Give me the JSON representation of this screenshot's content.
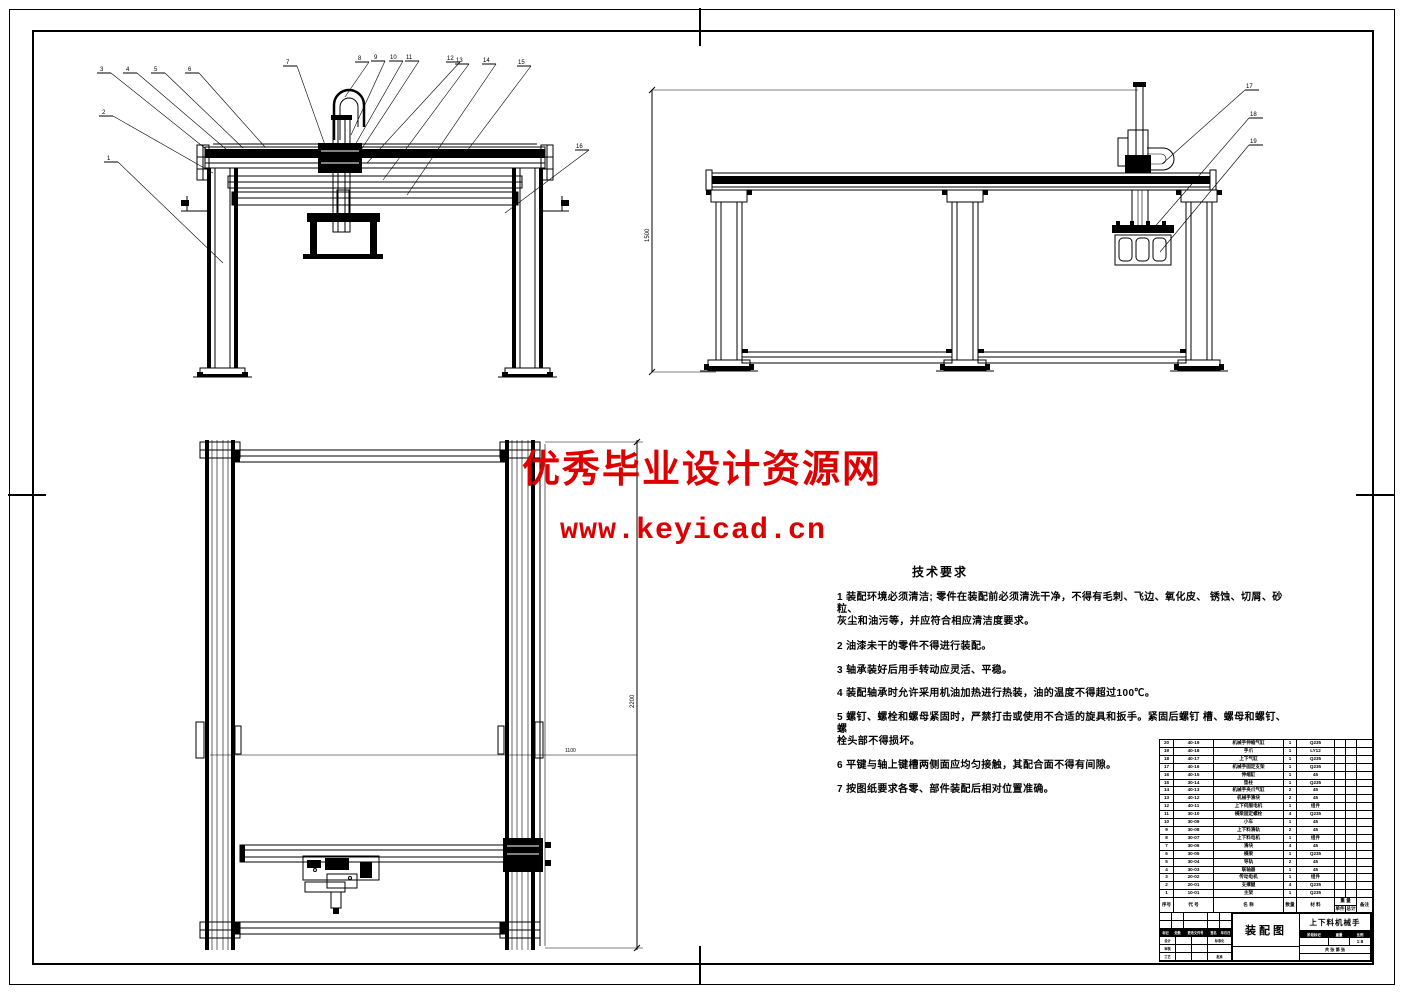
{
  "sheet": {
    "background": "#ffffff",
    "line_color": "#000000",
    "watermark_color": "#dd0000"
  },
  "watermarks": {
    "line1": "优秀毕业设计资源网",
    "line2": "www.keyicad.cn"
  },
  "tech": {
    "title": "技术要求",
    "lines": [
      "1 装配环境必须清洁; 零件在装配前必须清洗干净，不得有毛刺、飞边、氧化皮、  锈蚀、切屑、砂粒、",
      "灰尘和油污等，并应符合相应清洁度要求。",
      "2 油漆未干的零件不得进行装配。",
      "3 轴承装好后用手转动应灵活、平稳。",
      "4 装配轴承时允许采用机油加热进行热装，油的温度不得超过100℃。",
      "5 螺钉、螺栓和螺母紧固时，严禁打击或使用不合适的旋具和扳手。紧固后螺钉   槽、螺母和螺钉、螺",
      "栓头部不得损坏。",
      "6 平键与轴上键槽两侧面应均匀接触，其配合面不得有间隙。",
      "7 按图纸要求各零、部件装配后相对位置准确。"
    ]
  },
  "views": {
    "front": {
      "callouts": [
        "1",
        "2",
        "3",
        "4",
        "5",
        "6",
        "7",
        "8",
        "9",
        "10",
        "11",
        "12",
        "13",
        "14",
        "15",
        "16"
      ]
    },
    "side": {
      "callouts": [
        "17",
        "18",
        "19"
      ],
      "dim_height": "1500"
    },
    "plan": {
      "dim_length": "2200",
      "dim_mid": "1100"
    }
  },
  "bom": {
    "headers": {
      "seq": "序号",
      "code": "代 号",
      "name": "名 称",
      "qty": "数量",
      "material": "材 料",
      "weight": "重 量",
      "unit": "单件",
      "total": "总计",
      "remark": "备注"
    },
    "rows": [
      {
        "seq": "20",
        "code": "40-19",
        "name": "机械手伸缩气缸",
        "qty": "1",
        "material": "Q235",
        "unit_weight": "",
        "total_weight": "",
        "remark": ""
      },
      {
        "seq": "19",
        "code": "40-18",
        "name": "手爪",
        "qty": "1",
        "material": "LY12",
        "unit_weight": "",
        "total_weight": "",
        "remark": ""
      },
      {
        "seq": "18",
        "code": "40-17",
        "name": "上下气缸",
        "qty": "1",
        "material": "Q235",
        "unit_weight": "",
        "total_weight": "",
        "remark": ""
      },
      {
        "seq": "17",
        "code": "40-16",
        "name": "机械手固定支架",
        "qty": "1",
        "material": "Q235",
        "unit_weight": "",
        "total_weight": "",
        "remark": ""
      },
      {
        "seq": "16",
        "code": "40-15",
        "name": "伸缩缸",
        "qty": "1",
        "material": "45",
        "unit_weight": "",
        "total_weight": "",
        "remark": ""
      },
      {
        "seq": "15",
        "code": "30-14",
        "name": "垫柱",
        "qty": "1",
        "material": "Q235",
        "unit_weight": "",
        "total_weight": "",
        "remark": ""
      },
      {
        "seq": "14",
        "code": "40-13",
        "name": "机械手夹爪气缸",
        "qty": "2",
        "material": "45",
        "unit_weight": "",
        "total_weight": "",
        "remark": ""
      },
      {
        "seq": "13",
        "code": "40-12",
        "name": "机械手滑块",
        "qty": "2",
        "material": "45",
        "unit_weight": "",
        "total_weight": "",
        "remark": ""
      },
      {
        "seq": "12",
        "code": "40-11",
        "name": "上下伺服电机",
        "qty": "1",
        "material": "组件",
        "unit_weight": "",
        "total_weight": "",
        "remark": ""
      },
      {
        "seq": "11",
        "code": "30-10",
        "name": "横梁固定螺栓",
        "qty": "4",
        "material": "Q235",
        "unit_weight": "",
        "total_weight": "",
        "remark": ""
      },
      {
        "seq": "10",
        "code": "30-09",
        "name": "小车",
        "qty": "1",
        "material": "45",
        "unit_weight": "",
        "total_weight": "",
        "remark": ""
      },
      {
        "seq": "9",
        "code": "30-08",
        "name": "上下料滑轨",
        "qty": "2",
        "material": "45",
        "unit_weight": "",
        "total_weight": "",
        "remark": ""
      },
      {
        "seq": "8",
        "code": "30-07",
        "name": "上下料电机",
        "qty": "1",
        "material": "组件",
        "unit_weight": "",
        "total_weight": "",
        "remark": ""
      },
      {
        "seq": "7",
        "code": "30-06",
        "name": "滑块",
        "qty": "4",
        "material": "45",
        "unit_weight": "",
        "total_weight": "",
        "remark": ""
      },
      {
        "seq": "6",
        "code": "30-05",
        "name": "横梁",
        "qty": "1",
        "material": "Q235",
        "unit_weight": "",
        "total_weight": "",
        "remark": ""
      },
      {
        "seq": "5",
        "code": "30-04",
        "name": "导轨",
        "qty": "2",
        "material": "45",
        "unit_weight": "",
        "total_weight": "",
        "remark": ""
      },
      {
        "seq": "4",
        "code": "30-03",
        "name": "联轴器",
        "qty": "1",
        "material": "45",
        "unit_weight": "",
        "total_weight": "",
        "remark": ""
      },
      {
        "seq": "3",
        "code": "20-02",
        "name": "传动电机",
        "qty": "1",
        "material": "组件",
        "unit_weight": "",
        "total_weight": "",
        "remark": ""
      },
      {
        "seq": "2",
        "code": "20-01",
        "name": "支撑腿",
        "qty": "4",
        "material": "Q235",
        "unit_weight": "",
        "total_weight": "",
        "remark": ""
      },
      {
        "seq": "1",
        "code": "10-01",
        "name": "主架",
        "qty": "1",
        "material": "Q235",
        "unit_weight": "",
        "total_weight": "",
        "remark": ""
      }
    ]
  },
  "title_block": {
    "drawing_name": "装配图",
    "project_name": "上下料机械手",
    "rev_row": [
      "标记",
      "处数",
      "分区",
      "更改文件号",
      "签名",
      "年月日"
    ],
    "sign_labels": {
      "design": "设计",
      "standard": "标准化",
      "audit": "审核",
      "process": "工艺",
      "approve": "批准"
    },
    "stage_row": [
      "阶段标记",
      "重量",
      "比例"
    ],
    "scale": "1:8",
    "sheet_row": "共 张 第 张"
  }
}
